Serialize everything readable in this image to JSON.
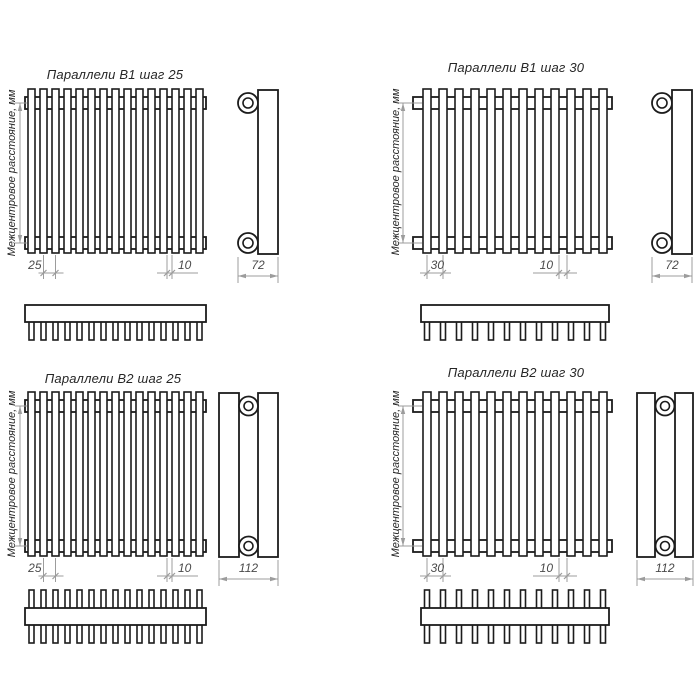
{
  "page": {
    "background": "#ffffff"
  },
  "drawing": {
    "axis_label": "Межцентровое расстояние, мм",
    "colors": {
      "line": "#1c1c1c",
      "dim_line": "#9c9c9c",
      "dim_text": "#4a4a4a",
      "title_text": "#262626",
      "background": "#ffffff"
    },
    "variants": [
      {
        "id": "b1-step-25",
        "title": "Параллели В1 шаг 25",
        "pitch": "25",
        "gap": "10",
        "depth": "72",
        "tube_count": 15,
        "rows": 1
      },
      {
        "id": "b1-step-30",
        "title": "Параллели В1 шаг 30",
        "pitch": "30",
        "gap": "10",
        "depth": "72",
        "tube_count": 12,
        "rows": 1
      },
      {
        "id": "b2-step-25",
        "title": "Параллели В2 шаг 25",
        "pitch": "25",
        "gap": "10",
        "depth": "112",
        "tube_count": 15,
        "rows": 2
      },
      {
        "id": "b2-step-30",
        "title": "Параллели В2 шаг 30",
        "pitch": "30",
        "gap": "10",
        "depth": "112",
        "tube_count": 12,
        "rows": 2
      }
    ]
  }
}
